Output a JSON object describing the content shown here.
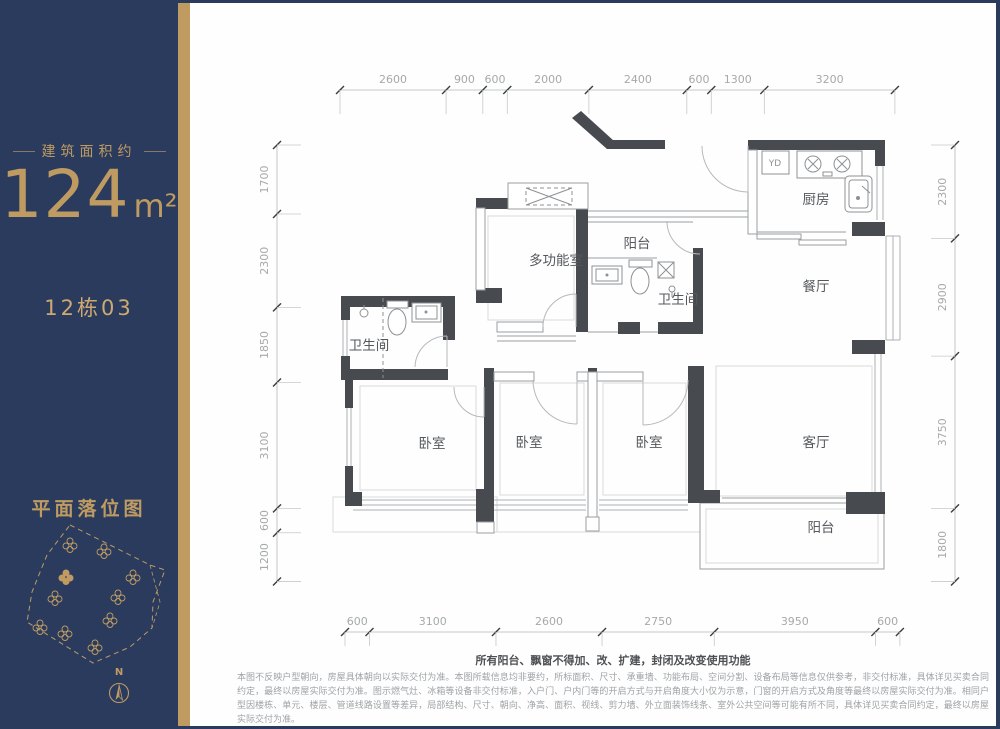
{
  "sidebar": {
    "area_label": "建筑面积约",
    "area_value": "124",
    "area_unit": "m²",
    "unit_number": "12栋03",
    "siteplan_title": "平面落位图",
    "compass_label": "N"
  },
  "plan": {
    "rooms": {
      "multi": "多功能室",
      "balcony_top": "阳台",
      "kitchen": "厨房",
      "dining": "餐厅",
      "bath_small": "卫生间",
      "bath_left": "卫生间",
      "bedroom1": "卧室",
      "bedroom2": "卧室",
      "bedroom3": "卧室",
      "living": "客厅",
      "balcony_bottom": "阳台"
    },
    "labels": {
      "appliance": "YD"
    },
    "dimensions": {
      "top": [
        2600,
        900,
        600,
        2000,
        2400,
        600,
        1300,
        3200
      ],
      "bottom": [
        600,
        3100,
        2600,
        2750,
        3950,
        600
      ],
      "left": [
        1700,
        2300,
        1850,
        3100,
        600,
        1200
      ],
      "right": [
        2300,
        2900,
        3750,
        1800
      ]
    }
  },
  "disclaimer": {
    "headline": "所有阳台、飘窗不得加、改、扩建，封闭及改变使用功能",
    "body": "本图不反映户型朝向，房屋具体朝向以实际交付为准。本图所载信息均非要约，所标面积、尺寸、承重墙、功能布局、空间分割、设备布局等信息仅供参考，非交付标准，具体详见买卖合同约定，最终以房屋实际交付为准。图示燃气灶、冰箱等设备非交付标准，入户门、户内门等的开启方式与开启角度大小仅为示意，门窗的开启方式及角度等最终以房屋实际交付为准。相同户型因楼栋、单元、楼层、管道线路设置等差异，局部结构、尺寸、朝向、净高、面积、视线、剪力墙、外立面装饰线条、室外公共空间等可能有所不同，具体详见买卖合同约定，最终以房屋实际交付为准。"
  },
  "colors": {
    "navy": "#2a3b5e",
    "gold": "#bf9b62",
    "wall": "#474b50",
    "dim": "#a6a9ab",
    "label": "#55585c"
  }
}
